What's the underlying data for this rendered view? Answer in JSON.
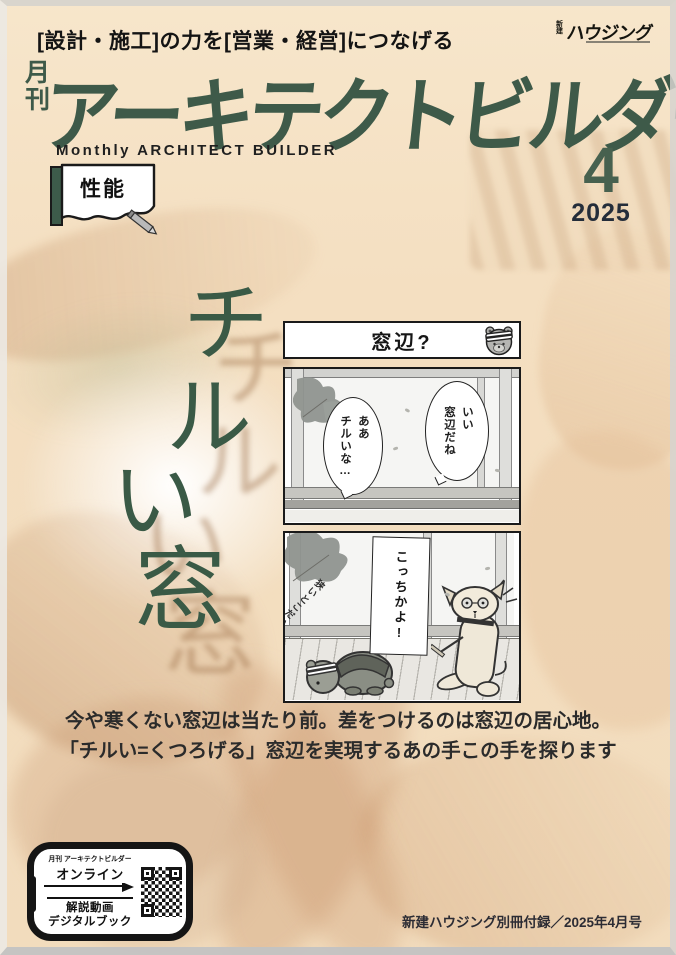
{
  "header": {
    "tagline": "[設計・施工]の力を[営業・経営]につなげる",
    "publisher_small": "新建",
    "publisher_main": "ハウジング",
    "magazine_prefix": "月刊",
    "magazine_title": "アーキテクトビルダー",
    "magazine_subtitle": "Monthly ARCHITECT BUILDER",
    "topic_badge": "性能",
    "issue_month": "4",
    "issue_year": "2025"
  },
  "feature": {
    "title": "チルい窓",
    "chars": [
      "チ",
      "ル",
      "い",
      "窓"
    ]
  },
  "manga": {
    "panel_title": "窓辺?",
    "bubble_right": "いい\n窓辺だね",
    "bubble_left": "ああ\nチルいな…",
    "banner": "こっちかよ!",
    "handwritten": "狭いとこだいすき"
  },
  "lead": {
    "line1": "今や寒くない窓辺は当たり前。差をつけるのは窓辺の居心地。",
    "line2": "「チルい=くつろげる」窓辺を実現するあの手この手を探ります"
  },
  "footer": {
    "phone_badge": {
      "small_label": "月刊 アーキテクトビルダー",
      "online_label": "オンライン",
      "video_label": "解説動画",
      "book_label": "デジタルブック"
    },
    "credit": "新建ハウジング別冊付録／2025年4月号"
  },
  "icons": {
    "pencil": "pencil-shape",
    "arrow": "right-arrow",
    "bear_face": "bear-face-drawing",
    "qr": "qr-code-pattern",
    "phone_frame": "smartphone-outline"
  },
  "colors": {
    "accent_green": "#3e5a49",
    "title_green": "#3a5a46",
    "dark_navy": "#242d3a",
    "bg_peach": "#f4dfc1",
    "manga_border": "#1a1a1a"
  }
}
